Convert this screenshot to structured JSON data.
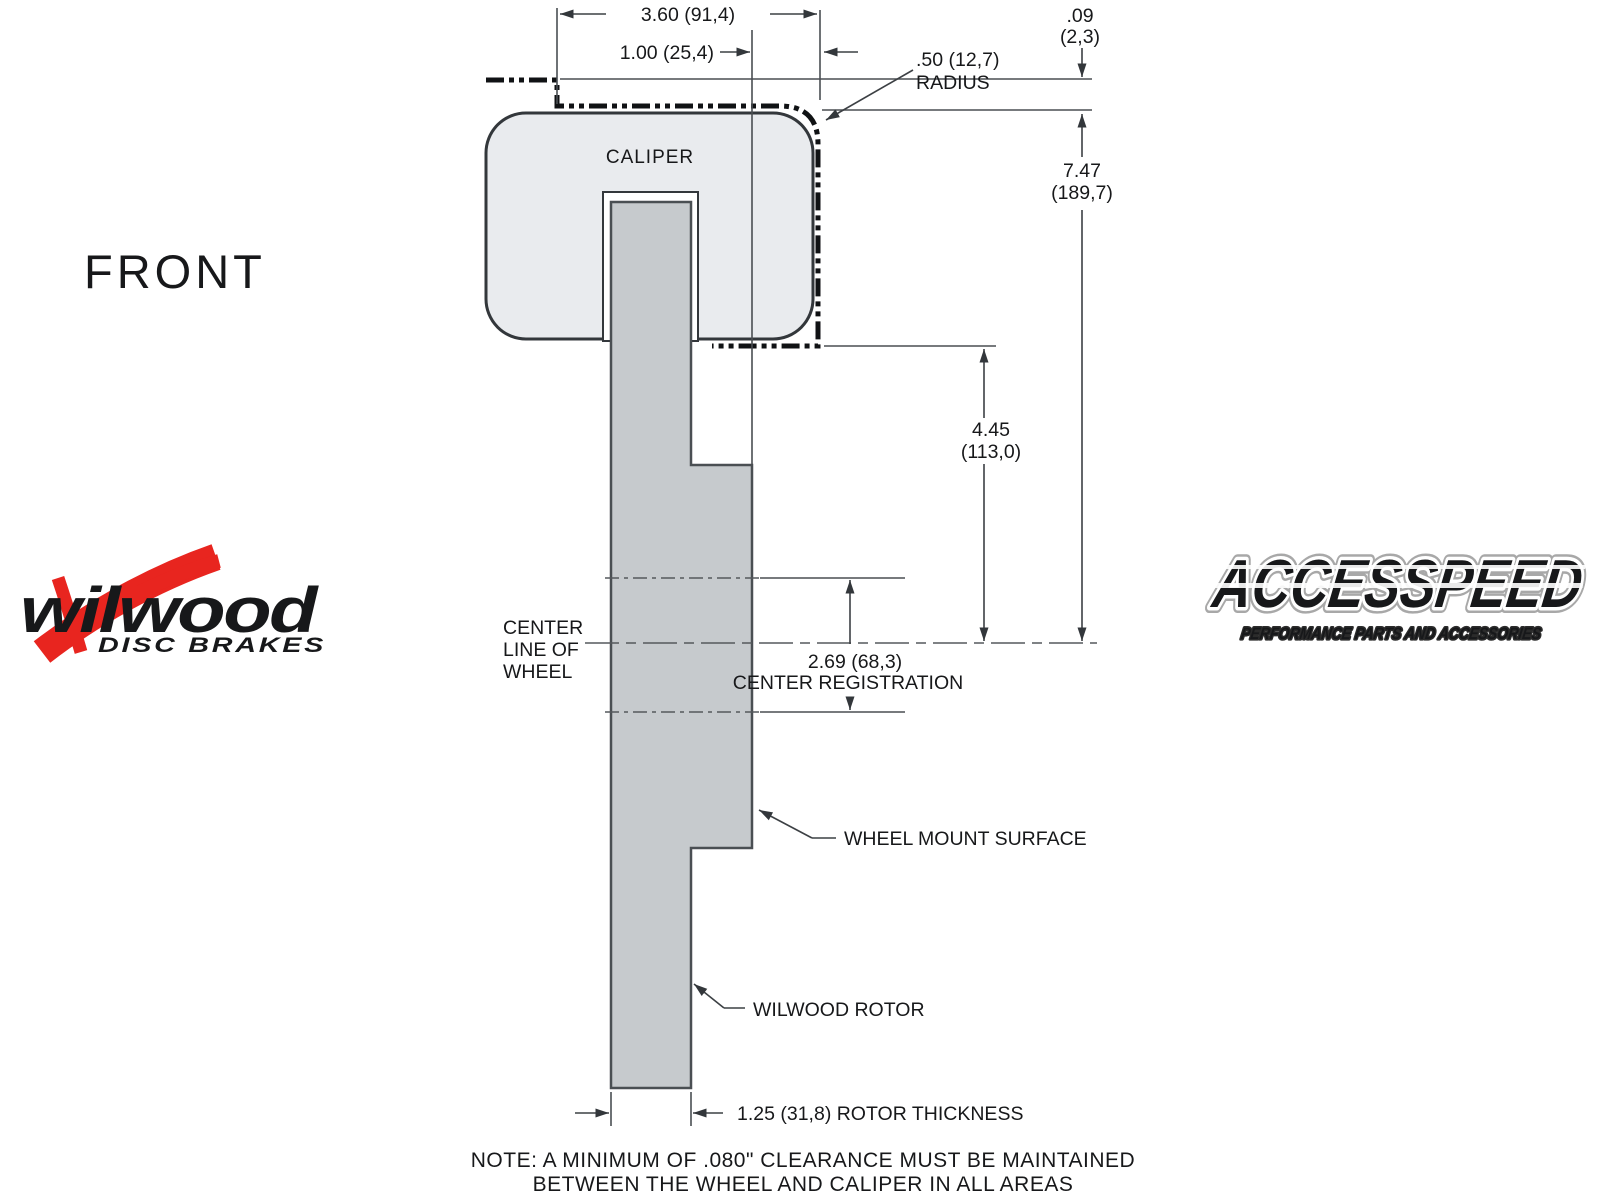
{
  "front_label": "FRONT",
  "caliper_label": "CALIPER",
  "dims": {
    "top_width": "3.60 (91,4)",
    "top_offset": "1.00 (25,4)",
    "radius_l1": ".50 (12,7)",
    "radius_l2": "RADIUS",
    "clearance_l1": ".09",
    "clearance_l2": "(2,3)",
    "overall_l1": "7.47",
    "overall_l2": "(189,7)",
    "caliper_drop_l1": "4.45",
    "caliper_drop_l2": "(113,0)",
    "registration_value": "2.69 (68,3)",
    "registration_label": "CENTER REGISTRATION",
    "rotor_thickness_label": "1.25 (31,8) ROTOR THICKNESS"
  },
  "labels": {
    "centerline_l1": "CENTER",
    "centerline_l2": "LINE OF",
    "centerline_l3": "WHEEL",
    "wheel_mount": "WHEEL MOUNT SURFACE",
    "rotor": "WILWOOD ROTOR"
  },
  "note": {
    "line1": "NOTE: A MINIMUM OF .080\" CLEARANCE MUST BE MAINTAINED",
    "line2": "BETWEEN THE WHEEL AND CALIPER IN ALL AREAS"
  },
  "logos": {
    "wilwood": {
      "wordmark": "wilwood",
      "subtitle": "DISC BRAKES"
    },
    "accesspeed": {
      "wordmark": "ACCESSPEED",
      "subtitle": "PERFORMANCE PARTS AND ACCESSORIES"
    }
  },
  "colors": {
    "background": "#ffffff",
    "caliper_fill": "#e9ebee",
    "rotor_fill": "#c6cacd",
    "line": "#4a4e52",
    "text": "#17181a",
    "logo_red": "#e8251f"
  }
}
